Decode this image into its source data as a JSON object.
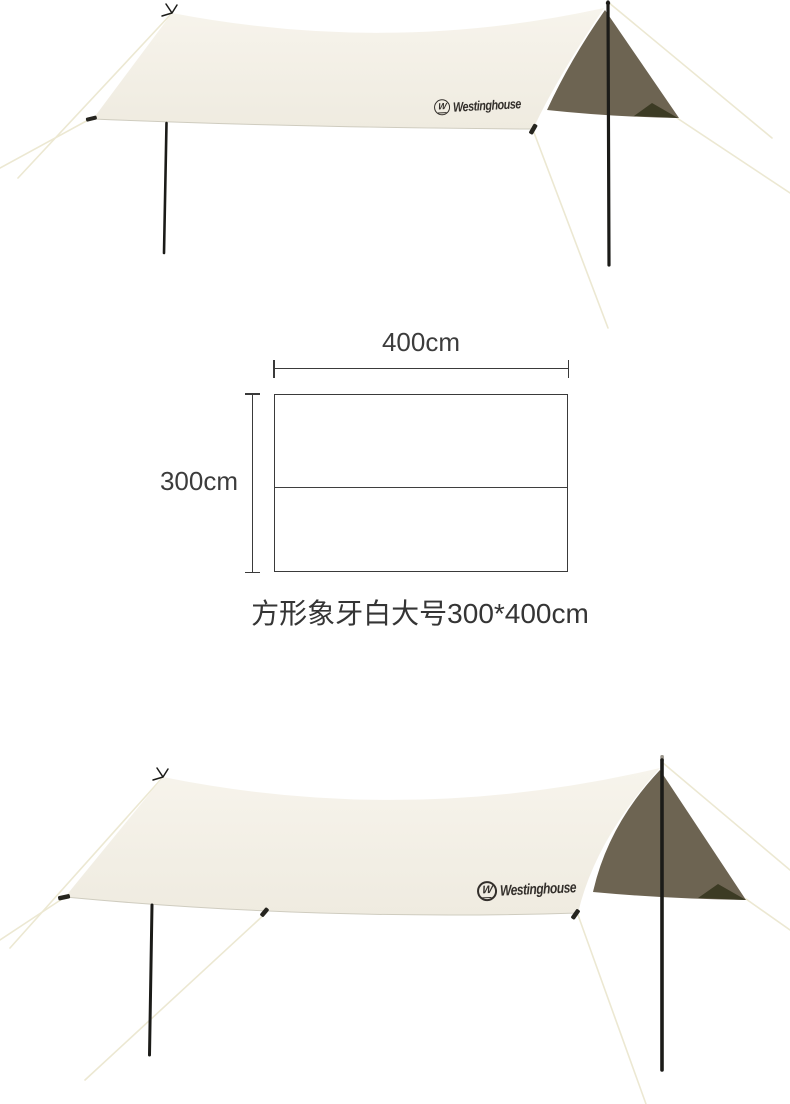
{
  "brand": {
    "name": "Westinghouse",
    "mark_letter": "W"
  },
  "diagram": {
    "width_label": "400cm",
    "height_label": "300cm",
    "width_cm": 400,
    "height_cm": 300,
    "caption": "方形象牙白大号300*400cm"
  },
  "illustrations": [
    {
      "id": "top-tarp",
      "description": "ivory tarp canopy with poles and guy ropes",
      "logo": "Westinghouse"
    },
    {
      "id": "bottom-tarp",
      "description": "ivory tarp canopy with poles and guy ropes",
      "logo": "Westinghouse"
    }
  ],
  "colors": {
    "tarp": "#f7f4ec",
    "tarp-deep": "#efebe0",
    "underside": "#6d6452",
    "underside-dark": "#3c3b24",
    "rope": "#ece8d2",
    "pole": "#1b1b18",
    "ink": "#3c3c3c",
    "logo-ink": "#332f2b"
  }
}
